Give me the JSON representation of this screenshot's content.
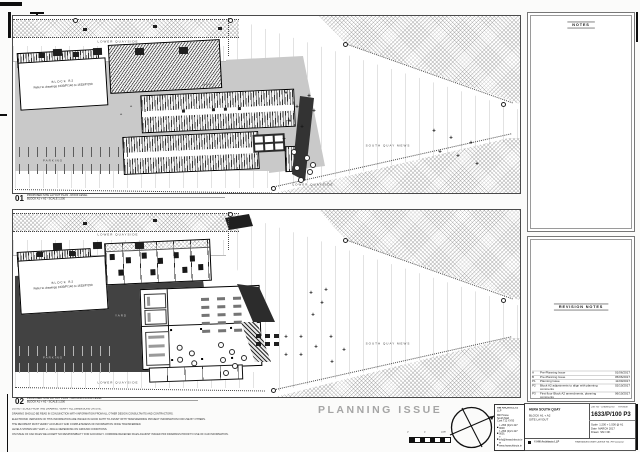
{
  "sheet": {
    "planning_issue": "PLANNING ISSUE"
  },
  "plan1": {
    "number": "01",
    "caption_line1": "PROPOSED SITE LAYOUT PLAN - ROOF LEVEL",
    "caption_line2": "BLOCK A1 + A2 - SCALE 1:200",
    "labels": {
      "lower_quayside_top": "LOWER QUAYSIDE",
      "lower_quayside_bottom": "LOWER QUAYSIDE",
      "yard": "YARD",
      "mews": "MEWS",
      "parking": "PARKING",
      "south_quay_mews": "SOUTH QUAY MEWS",
      "block_note_title": "BLOCK B2",
      "block_note_text": "Refer to drawings 1633/P/140 to 1633/P/150"
    }
  },
  "plan2": {
    "number": "02",
    "caption_line1": "PROPOSED SITE LAYOUT PLAN - GROUND FLOOR LEVEL",
    "caption_line2": "BLOCK A1 + A2 - SCALE 1:200",
    "labels": {
      "lower_quayside_top": "LOWER QUAYSIDE",
      "lower_quayside_bottom": "LOWER QUAYSIDE",
      "yard": "YARD",
      "parking": "PARKING",
      "south_quay_mews": "SOUTH QUAY MEWS",
      "block_note_title": "BLOCK B2",
      "block_note_text": "Refer to drawings 1633/P/140 to 1633/P/150"
    }
  },
  "notes_panel": {
    "title": "NOTES"
  },
  "revision_panel": {
    "title": "REVISION NOTES",
    "rows": [
      {
        "rev": "A",
        "note": "Pre-Planning Issue",
        "date": "01/06/2017"
      },
      {
        "rev": "B",
        "note": "Pre-Planning Issue",
        "date": "05/06/2017"
      },
      {
        "rev": "P1",
        "note": "Planning Issue",
        "date": "11/09/2017"
      },
      {
        "rev": "P2",
        "note": "Block A2 adjustments to align with planning comments",
        "date": "02/10/2017"
      },
      {
        "rev": "P3",
        "note": "First floor Block A2 amendments, planning comments",
        "date": "06/10/2017"
      }
    ]
  },
  "title_block": {
    "project": "HERA SOUTH QUAY",
    "block": "BLOCK A1 + A2",
    "drawing_title": "SITE LAYOUT",
    "number_label": "Job No - Drawing No",
    "revision_label": "Revision",
    "number": "1633/P/100 P3",
    "scale_label": "Scale",
    "scale": "1:200 + 1:500 @ A1",
    "date_label": "Date",
    "date": "MARCH 2017",
    "drawn_label": "Drawn",
    "drawn": "SM / DK",
    "copyright": "© HW Architects LLP",
    "licence": "Reproduced under Licence No. AR 0021017"
  },
  "architect": {
    "name": "HW ARCHITECTS",
    "sub": "LLP",
    "address1": "Mill House",
    "address2": "South Mall",
    "address3": "Cork T12 XY00",
    "contact1": "t +353 (0)21 427 0000",
    "contact2": "f +353 (0)21 427 0001",
    "contact3": "e info@hwarchitects.ie",
    "contact4": "w www.hwarchitects.ie"
  },
  "scale_bar": {
    "labels": [
      "0",
      "5",
      "10m"
    ]
  },
  "disclaimers": [
    "DO NOT SCALE FROM THIS DRAWING. VERIFY ALL DIMENSIONS ON SITE.",
    "DRAWING SHOULD BE READ IN CONJUNCTION WITH INFORMATION FROM ALL OTHER DESIGN CONSULTANTS AND CONTRACTORS.",
    "ELECTRONIC VERSIONS OF THIS INFORMATION ARE ISSUED IN GOOD FAITH TO ASSIST WITH TRANSFERRING PROJECT INFORMATION FOR USE BY OTHERS.",
    "THE RECIPIENT MUST VERIFY ACCURACY AND COMPLETENESS OF INFORMATION ONCE TRANSFERRED.",
    "LEVELS SHOWN MAY VARY +/- 300mm DEPENDING ON GROUND CONDITIONS.",
    "ON ISSUE OF CAD FILES WE ACCEPT NO RESPONSIBILITY FOR ACCURACY. COMPARE RECEIVED FILES AGAINST ISSUED PDF DRAWINGS PRIOR TO USE OF CAD INFORMATION."
  ]
}
